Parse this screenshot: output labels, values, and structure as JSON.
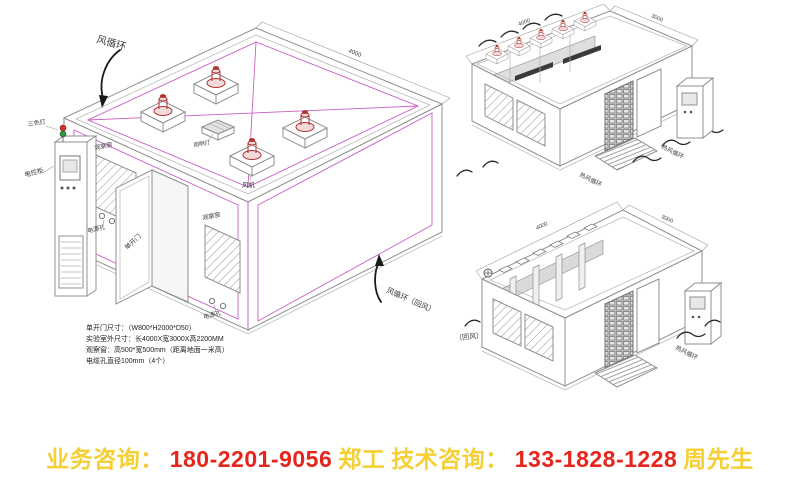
{
  "footer": {
    "business_label": "业务咨询：",
    "business_phone": "180-2201-9056",
    "business_contact": "郑工",
    "tech_label": "技术咨询：",
    "tech_phone": "133-1828-1228",
    "tech_contact": "周先生"
  },
  "main_diagram": {
    "flow_top_label": "风循环",
    "flow_return_label": "风循环（回风）",
    "fan_label": "风机",
    "roof_box_label": "照明灯",
    "tricolor_light_label": "三色灯",
    "cabinet_label": "电控柜",
    "window_left_label": "观察窗",
    "power_holes_left_label": "电源孔",
    "door_label": "单开门",
    "window_right_label": "观察窗",
    "power_holes_right_label": "电源孔",
    "dimension_top": "4000",
    "notes": [
      "单开门尺寸：（W800*H2000*D50）",
      "实验室外尺寸：长4000X宽3000X高2200MM",
      "观察窗：高500*宽500mm（距离地面一米高）",
      "电缆孔直径100mm（4个）"
    ]
  },
  "top_right_diagram": {
    "dimension_long": "4000",
    "dimension_short": "3000",
    "flow_label_1": "热风循环",
    "flow_label_2": "热风循环"
  },
  "bottom_right_diagram": {
    "return_air_label": "（回风）",
    "flow_label": "热风循环",
    "dimension_long": "4000",
    "dimension_short": "3000"
  },
  "colors": {
    "accent_magenta": "#c75fc4",
    "fan_red": "#b03030",
    "footer_yellow": "#f5cf33",
    "footer_red": "#e8251d"
  }
}
